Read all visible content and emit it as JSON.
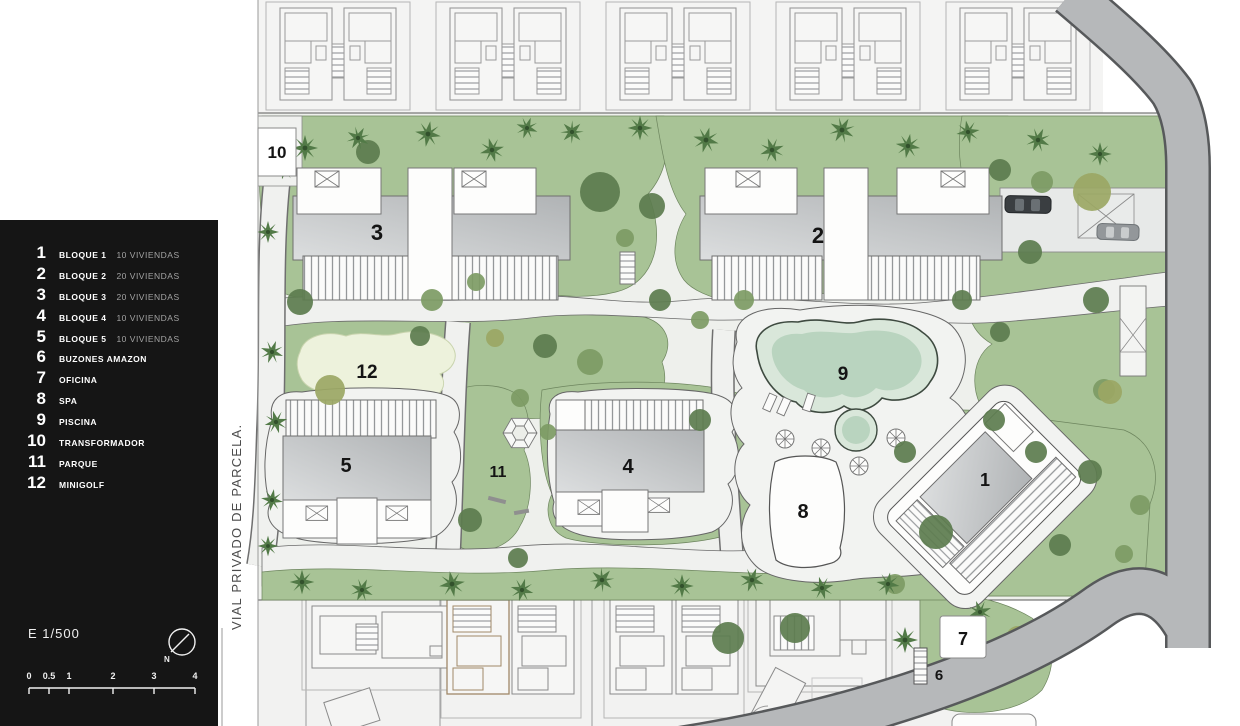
{
  "legend": {
    "items": [
      {
        "num": "1",
        "label": "BLOQUE 1",
        "detail": "10 VIVIENDAS"
      },
      {
        "num": "2",
        "label": "BLOQUE 2",
        "detail": "20 VIVIENDAS"
      },
      {
        "num": "3",
        "label": "BLOQUE 3",
        "detail": "20 VIVIENDAS"
      },
      {
        "num": "4",
        "label": "BLOQUE 4",
        "detail": "10 VIVIENDAS"
      },
      {
        "num": "5",
        "label": "BLOQUE 5",
        "detail": "10 VIVIENDAS"
      },
      {
        "num": "6",
        "label": "BUZONES AMAZON",
        "detail": ""
      },
      {
        "num": "7",
        "label": "OFICINA",
        "detail": ""
      },
      {
        "num": "8",
        "label": "SPA",
        "detail": ""
      },
      {
        "num": "9",
        "label": "PISCINA",
        "detail": ""
      },
      {
        "num": "10",
        "label": "TRANSFORMADOR",
        "detail": ""
      },
      {
        "num": "11",
        "label": "PARQUE",
        "detail": ""
      },
      {
        "num": "12",
        "label": "MINIGOLF",
        "detail": ""
      }
    ],
    "scale_text": "E 1/500",
    "north_label": "N",
    "scalebar_ticks": [
      "0",
      "0.5",
      "1",
      "2",
      "3",
      "4"
    ]
  },
  "plan": {
    "street_label": "VIAL PRIVADO DE PARCELA.",
    "markers": {
      "block1": "1",
      "block2": "2",
      "block3": "3",
      "block4": "4",
      "block5": "5",
      "buzones": "6",
      "oficina": "7",
      "spa": "8",
      "piscina": "9",
      "transformador": "10",
      "parque": "11",
      "minigolf": "12"
    },
    "colors": {
      "panel_bg": "#151515",
      "grass": "#a8c396",
      "path": "#f0f1ef",
      "pool": "#c6dcca",
      "road": "#b6b8ba",
      "building": "#bfc2c4",
      "minigolf": "#edf2dc"
    }
  }
}
